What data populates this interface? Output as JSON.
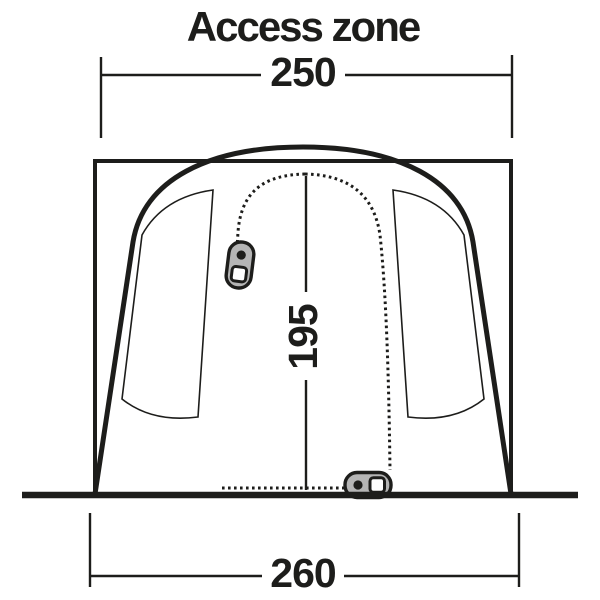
{
  "title": "Access zone",
  "dimensions": {
    "access_zone_width": "250",
    "door_height": "195",
    "base_width": "260"
  },
  "colors": {
    "ink": "#1d1d1b",
    "zipper_fill": "#b5b5b5",
    "background": "#ffffff"
  },
  "icons": {
    "left_door_zipper": "zipper-pull-icon",
    "bottom_door_zipper": "zipper-pull-icon"
  }
}
